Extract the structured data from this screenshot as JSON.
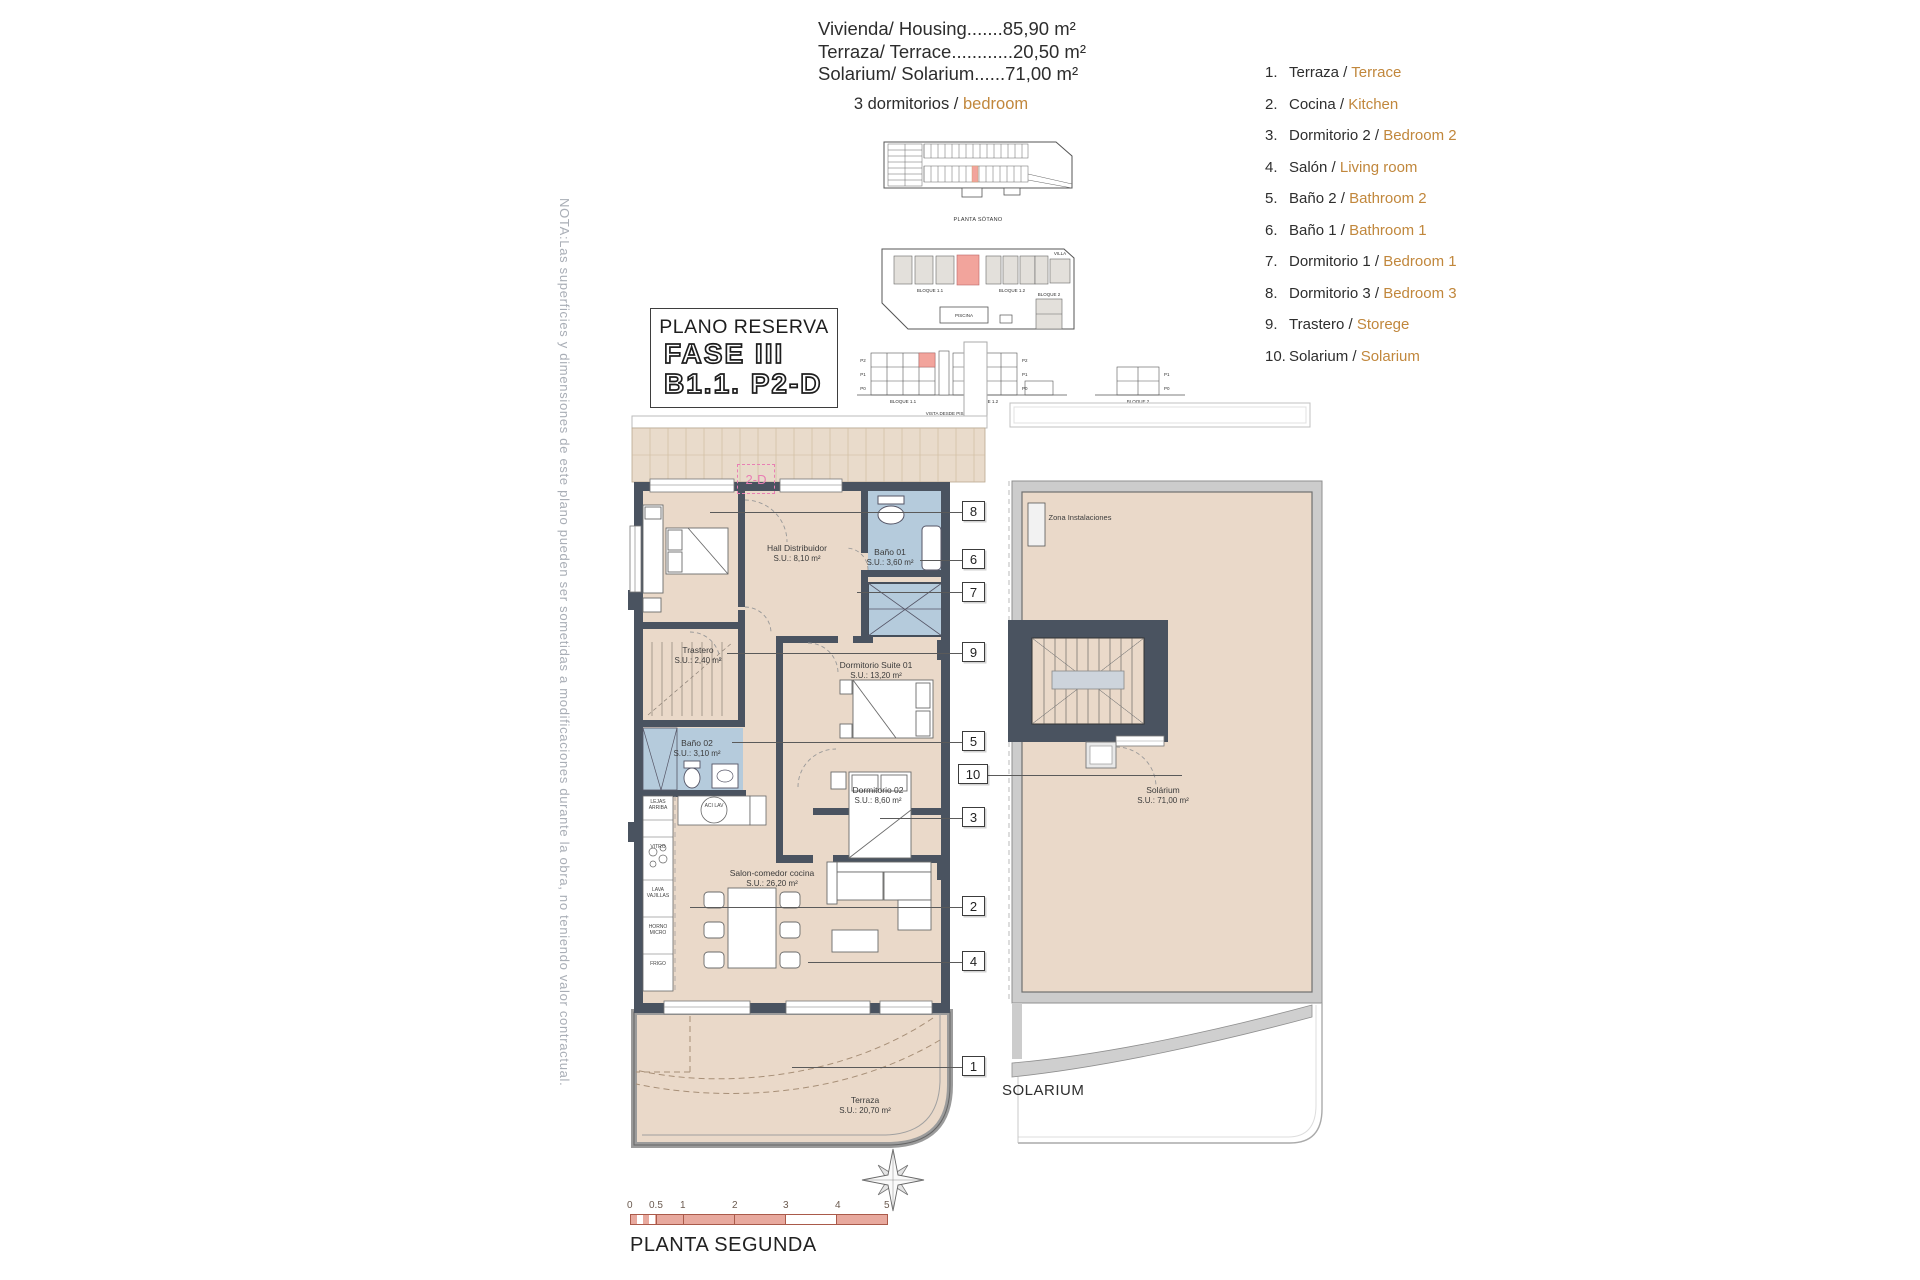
{
  "note": "NOTA:Las superficies y dimensiones de este plano pueden ser sometidas a modificaciones durante la obra, no teniendo valor contractual.",
  "areas": {
    "line1": "Vivienda/ Housing.......85,90 m²",
    "line2": "Terraza/ Terrace............20,50 m²",
    "line3": "Solarium/ Solarium......71,00 m²"
  },
  "bedrooms": {
    "es": "3 dormitorios /",
    "en": "bedroom"
  },
  "legend": {
    "items": [
      {
        "num": "1.",
        "es": "Terraza /",
        "en": "Terrace"
      },
      {
        "num": "2.",
        "es": "Cocina /",
        "en": "Kitchen"
      },
      {
        "num": "3.",
        "es": "Dormitorio 2 /",
        "en": "Bedroom 2"
      },
      {
        "num": "4.",
        "es": "Salón /",
        "en": "Living room"
      },
      {
        "num": "5.",
        "es": "Baño 2 /",
        "en": "Bathroom 2"
      },
      {
        "num": "6.",
        "es": "Baño 1 /",
        "en": "Bathroom 1"
      },
      {
        "num": "7.",
        "es": "Dormitorio 1 /",
        "en": "Bedroom 1"
      },
      {
        "num": "8.",
        "es": "Dormitorio 3 /",
        "en": "Bedroom 3"
      },
      {
        "num": "9.",
        "es": "Trastero /",
        "en": "Storege"
      },
      {
        "num": "10.",
        "es": "Solarium /",
        "en": "Solarium"
      }
    ]
  },
  "reserva": {
    "title": "PLANO RESERVA",
    "fase": "FASE III",
    "unit": "B1.1. P2-D"
  },
  "site": {
    "sotano": "PLANTA SÓTANO",
    "bloque11": "BLOQUE 1.1",
    "bloque12": "BLOQUE 1.2",
    "bloque2": "BLOQUE 2",
    "villa": "VILLA",
    "piscina": "PISCINA",
    "vista": "VISTA DESDE PISCINA",
    "p2": "P2",
    "p1": "P1",
    "p0": "P0"
  },
  "plan": {
    "unit_tag": "2-D",
    "rooms": {
      "hall": {
        "name": "Hall Distribuidor",
        "area": "S.U.: 8,10 m²"
      },
      "bano1": {
        "name": "Baño 01",
        "area": "S.U.: 3,60 m²"
      },
      "trastero": {
        "name": "Trastero",
        "area": "S.U.: 2,40 m²"
      },
      "suite": {
        "name": "Dormitorio Suite 01",
        "area": "S.U.: 13,20 m²"
      },
      "bano2": {
        "name": "Baño 02",
        "area": "S.U.: 3,10 m²"
      },
      "dorm2": {
        "name": "Dormitorio 02",
        "area": "S.U.: 8,60 m²"
      },
      "salon": {
        "name": "Salon-comedor cocina",
        "area": "S.U.: 26,20 m²"
      },
      "terraza": {
        "name": "Terraza",
        "area": "S.U.: 20,70 m²"
      },
      "solarium": {
        "name": "Solárium",
        "area": "S.U.: 71,00 m²"
      },
      "zona": {
        "name": "Zona Instalaciones"
      }
    },
    "kitchen": {
      "k1": "LEJAS ARRIBA",
      "k2": "VITRO",
      "k3": "LAVA VAJILLAS",
      "k4": "HORNO MICRO",
      "k5": "FRIGO",
      "k6": "ACI LAV"
    },
    "callouts": {
      "c1": "1",
      "c2": "2",
      "c3": "3",
      "c4": "4",
      "c5": "5",
      "c6": "6",
      "c7": "7",
      "c8": "8",
      "c9": "9",
      "c10": "10"
    },
    "solarium_caption": "SOLARIUM"
  },
  "scalebar": {
    "ticks": [
      "0",
      "0.5",
      "1",
      "2",
      "3",
      "4",
      "5"
    ],
    "caption": "PLANTA SEGUNDA"
  },
  "colors": {
    "accent_orange": "#c1873c",
    "room_fill": "#ead9c9",
    "bath_fill": "#b5cbdc",
    "wall": "#4a5360",
    "highlight_red": "#f2a49c",
    "pink": "#e97fb4"
  }
}
